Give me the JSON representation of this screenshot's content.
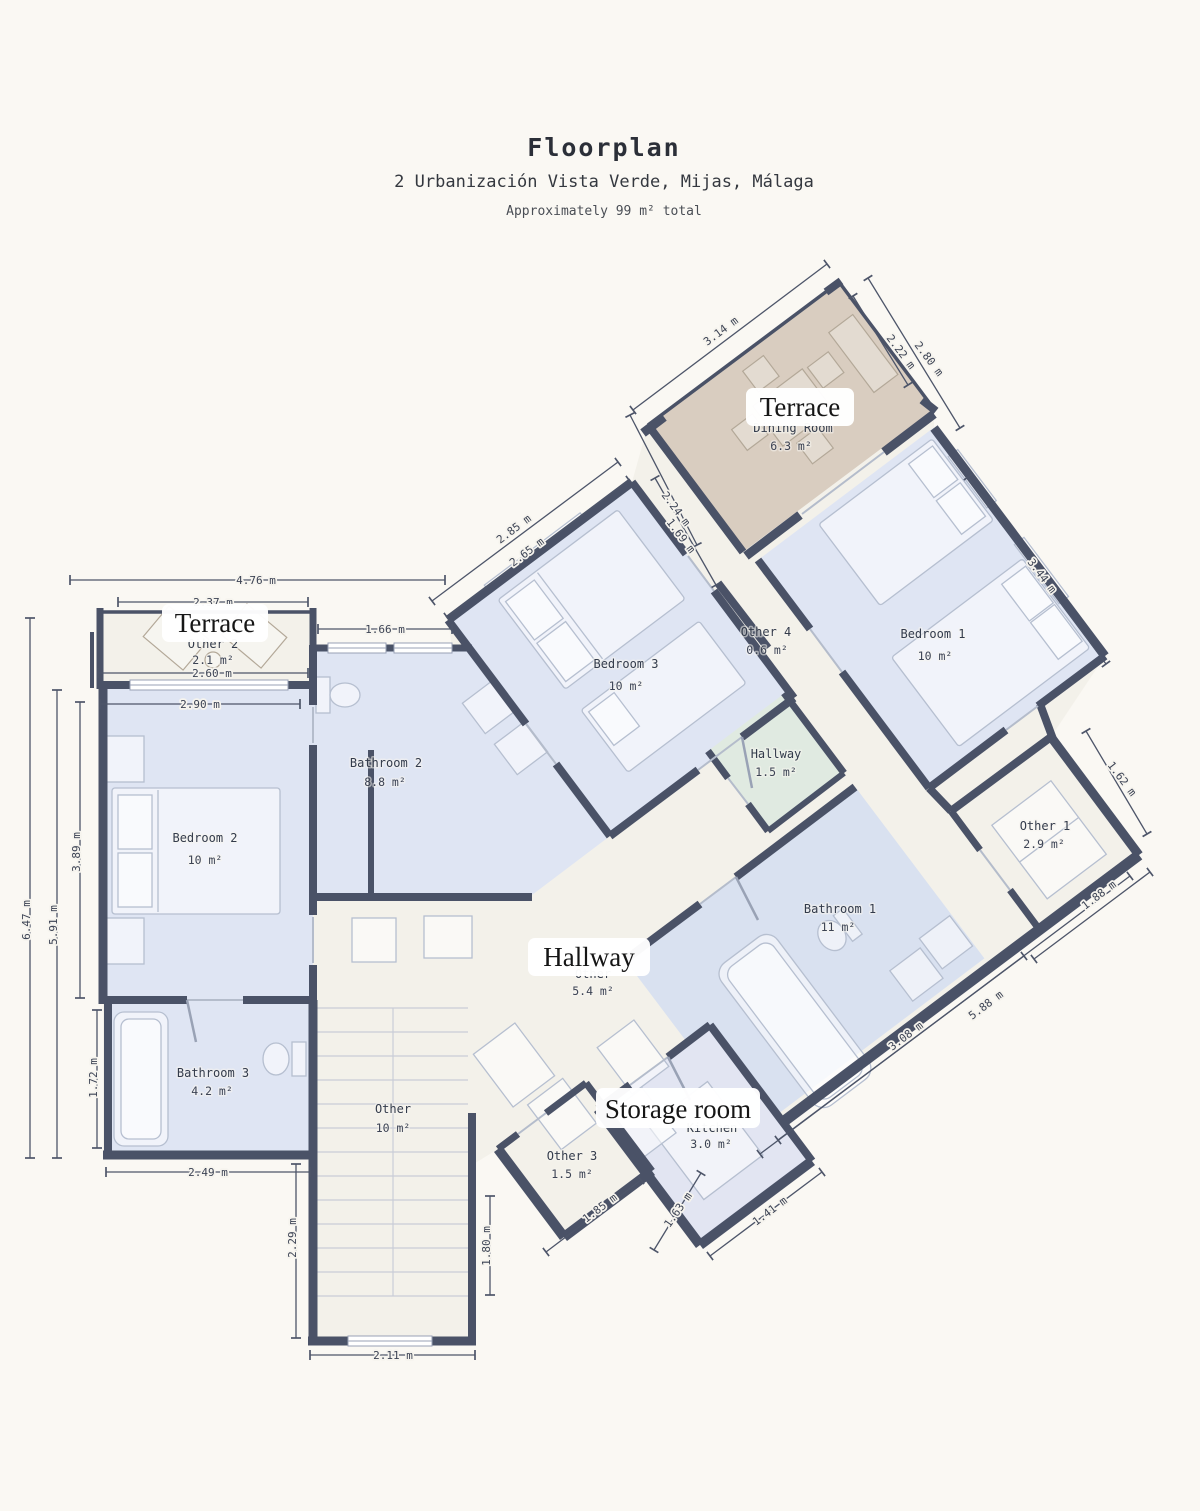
{
  "header": {
    "title": "Floorplan",
    "subtitle": "2 Urbanización Vista Verde, Mijas, Málaga",
    "note": "Approximately 99 m² total"
  },
  "overlay_labels": {
    "terrace_top": "Terrace",
    "terrace_left": "Terrace",
    "hallway": "Hallway",
    "storage": "Storage room"
  },
  "rooms": {
    "bedroom1": {
      "name": "Bedroom 1",
      "area": "10 m²"
    },
    "bedroom2": {
      "name": "Bedroom 2",
      "area": "10 m²"
    },
    "bedroom3": {
      "name": "Bedroom 3",
      "area": "10 m²"
    },
    "bathroom1": {
      "name": "Bathroom 1",
      "area": "11 m²"
    },
    "bathroom2": {
      "name": "Bathroom 2",
      "area": "8.8 m²"
    },
    "bathroom3": {
      "name": "Bathroom 3",
      "area": "4.2 m²"
    },
    "hallway_small": {
      "name": "Hallway",
      "area": "1.5 m²"
    },
    "hallway_main": {
      "name": "Other",
      "area": "5.4 m²"
    },
    "dining": {
      "name": "Dining Room",
      "area": "6.3 m²"
    },
    "kitchen": {
      "name": "Kitchen",
      "area": "3.0 m²"
    },
    "other1": {
      "name": "Other 1",
      "area": "2.9 m²"
    },
    "other2": {
      "name": "Other 2",
      "area": "2.1 m²"
    },
    "other3": {
      "name": "Other 3",
      "area": "1.5 m²"
    },
    "other4": {
      "name": "Other 4",
      "area": "0.6 m²"
    },
    "stairs": {
      "name": "Other",
      "area": "10 m²"
    }
  },
  "dimensions": [
    "4.76 m",
    "2.37 m",
    "1.66 m",
    "2.60 m",
    "2.90 m",
    "2.49 m",
    "2.11 m",
    "6.47 m",
    "5.91 m",
    "3.89 m",
    "1.72 m",
    "2.29 m",
    "1.80 m",
    "3.14 m",
    "2.85 m",
    "2.65 m",
    "2.24 m",
    "1.69 m",
    "2.22 m",
    "2.80 m",
    "3.44 m",
    "1.62 m",
    "1.88 m",
    "5.88 m",
    "3.08 m",
    "1.41 m",
    "1.63 m",
    "1.85 m"
  ],
  "colors": {
    "wall": "#4a5267",
    "room_blue": "#dfe5f3",
    "room_blue_deep": "#d9e1f0",
    "terrace_tan": "#d9cdc0",
    "hallway_green": "#e0eae1",
    "storage_lavender": "#e2e5f2",
    "corridor": "#f3f1ea",
    "background": "#faf8f3"
  }
}
